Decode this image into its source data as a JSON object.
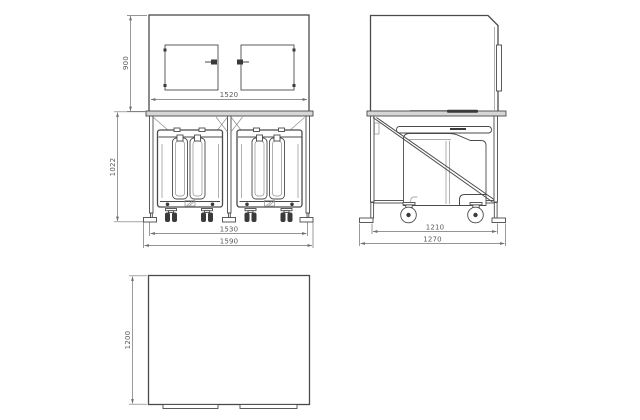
{
  "drawing": {
    "type": "orthographic-technical-drawing",
    "views": [
      {
        "id": "front-view",
        "parts": [
          "upper-cabinet-with-two-doors",
          "lower-frame-with-two-wheeled-bins"
        ]
      },
      {
        "id": "side-view",
        "parts": [
          "upper-cabinet",
          "lower-frame-with-diagonal-brace-and-wheeled-bin"
        ]
      },
      {
        "id": "plan-view",
        "parts": [
          "outline-with-two-tabs"
        ]
      }
    ],
    "dimensions": {
      "cabinet_height": {
        "value": "900",
        "orientation": "vertical",
        "view": "front"
      },
      "cabinet_width": {
        "value": "1520",
        "orientation": "horizontal",
        "view": "front"
      },
      "frame_height": {
        "value": "1022",
        "orientation": "vertical",
        "view": "front"
      },
      "wheelbase_width": {
        "value": "1530",
        "orientation": "horizontal",
        "view": "front"
      },
      "overall_width": {
        "value": "1590",
        "orientation": "horizontal",
        "view": "front"
      },
      "wheelbase_depth": {
        "value": "1210",
        "orientation": "horizontal",
        "view": "side"
      },
      "overall_depth": {
        "value": "1270",
        "orientation": "horizontal",
        "view": "side"
      },
      "plan_depth": {
        "value": "1200",
        "orientation": "vertical",
        "view": "plan"
      }
    },
    "colors": {
      "background": "#ffffff",
      "main_line": "#4a4a4a",
      "light_line": "#8e8e8e",
      "dimension": "#707070",
      "rail_fill": "#d6d6d6",
      "dark_fill": "#3a3a3a"
    }
  }
}
